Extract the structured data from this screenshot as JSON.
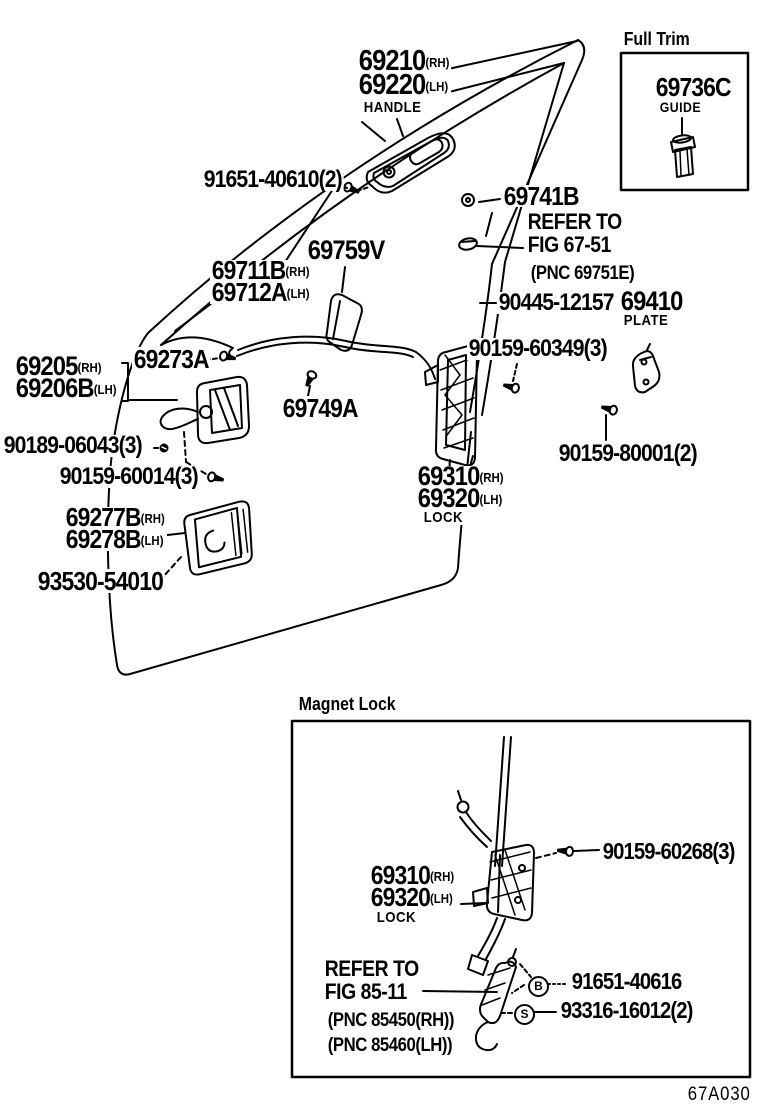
{
  "labels": {
    "handle_rh": {
      "num": "69210",
      "side": "(RH)"
    },
    "handle_lh": {
      "num": "69220",
      "side": "(LH)"
    },
    "handle_caption": "HANDLE",
    "screw_handle": "91651-40610(2)",
    "clip_69741b": "69741B",
    "refer1": {
      "l1": "REFER TO",
      "l2": "FIG 67-51",
      "l3": "(PNC 69751E)"
    },
    "pad": "69759V",
    "frame_rh": {
      "num": "69711B",
      "side": "(RH)"
    },
    "frame_lh": {
      "num": "69712A",
      "side": "(LH)"
    },
    "rod": "90445-12157",
    "plate": {
      "num": "69410",
      "caption": "PLATE"
    },
    "screw_60349": "90159-60349(3)",
    "screw_69273a": "69273A",
    "inhandle_rh": {
      "num": "69205",
      "side": "(RH)"
    },
    "inhandle_lh": {
      "num": "69206B",
      "side": "(LH)"
    },
    "clip_69749a": "69749A",
    "nut_90189": "90189-06043(3)",
    "screw_60014": "90159-60014(3)",
    "lock_rh": {
      "num": "69310",
      "side": "(RH)"
    },
    "lock_lh": {
      "num": "69320",
      "side": "(LH)"
    },
    "lock_caption": "LOCK",
    "screw_80001": "90159-80001(2)",
    "bezel_rh": {
      "num": "69277B",
      "side": "(RH)"
    },
    "bezel_lh": {
      "num": "69278B",
      "side": "(LH)"
    },
    "screw_93530": "93530-54010"
  },
  "full_trim": {
    "title": "Full Trim",
    "part": "69736C",
    "caption": "GUIDE"
  },
  "magnet_lock": {
    "title": "Magnet Lock",
    "screw_60268": "90159-60268(3)",
    "lock_rh": {
      "num": "69310",
      "side": "(RH)"
    },
    "lock_lh": {
      "num": "69320",
      "side": "(LH)"
    },
    "lock_caption": "LOCK",
    "refer": {
      "l1": "REFER TO",
      "l2": "FIG 85-11",
      "l3": "(PNC 85450(RH))",
      "l4": "(PNC 85460(LH))"
    },
    "bolt_b": {
      "letter": "B",
      "num": "91651-40616"
    },
    "screw_s": {
      "letter": "S",
      "num": "93316-16012(2)"
    }
  },
  "footer": {
    "code": "67A030"
  }
}
